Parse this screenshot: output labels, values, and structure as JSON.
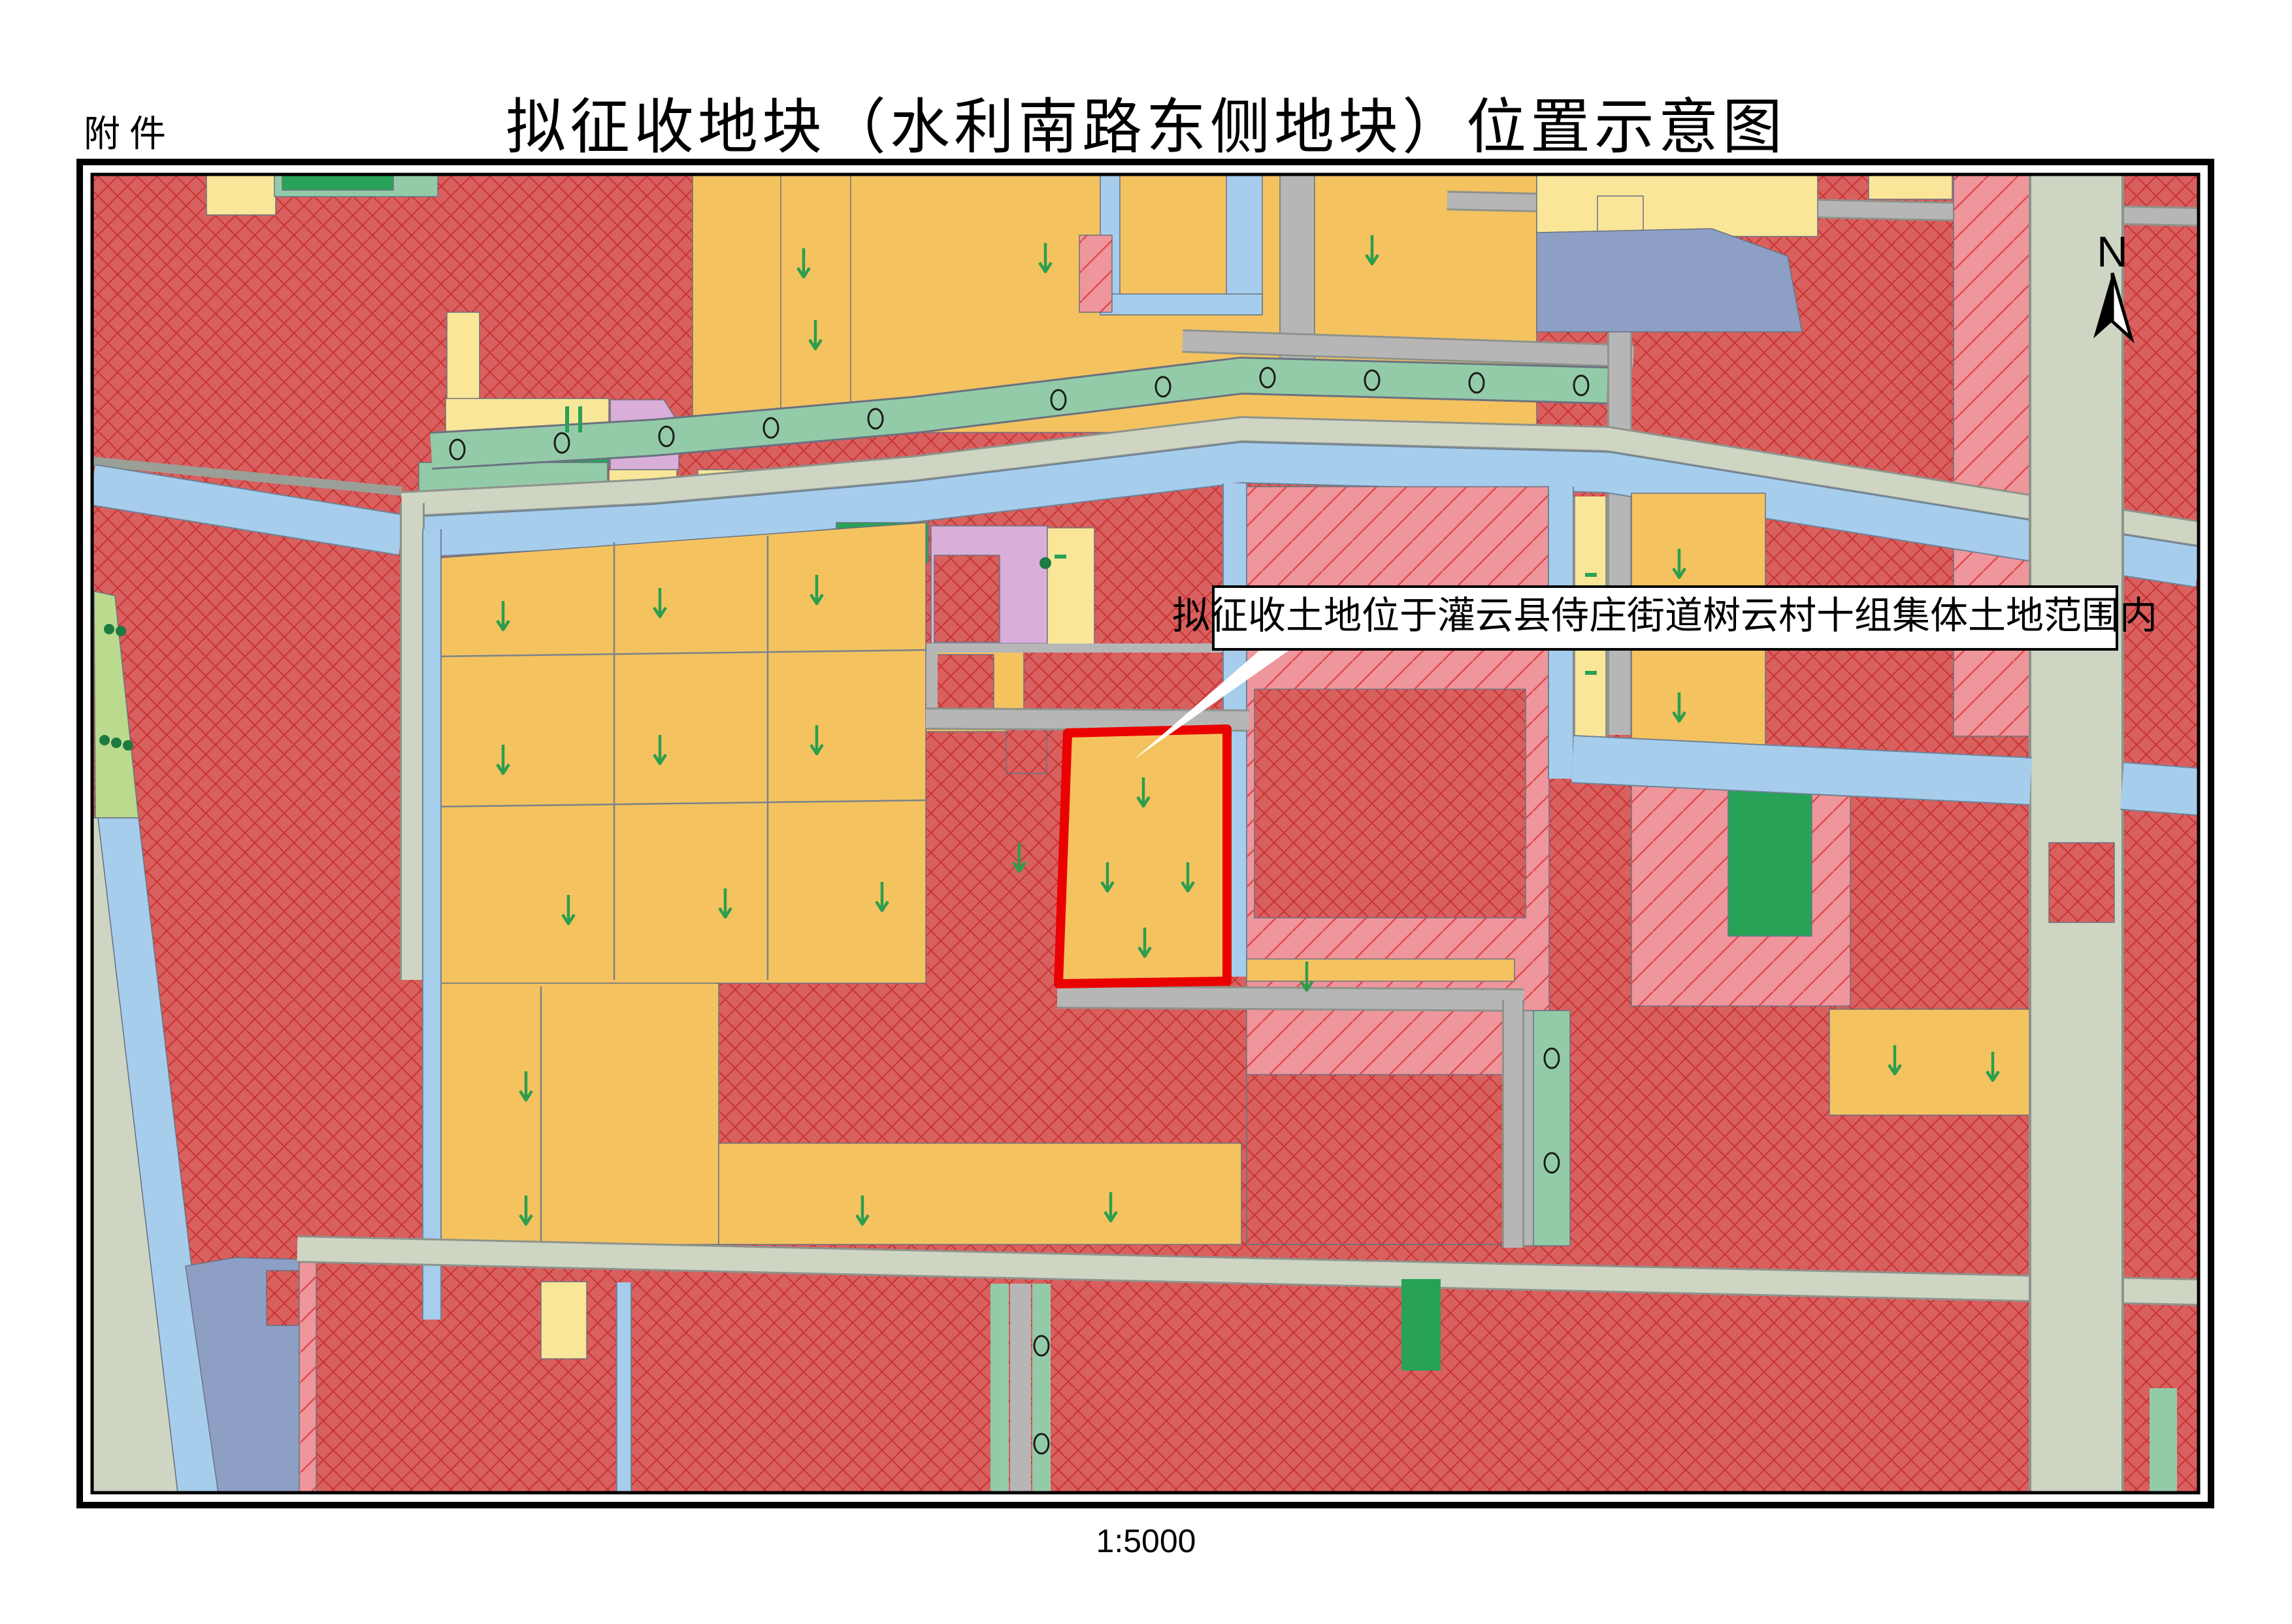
{
  "header": {
    "attachment_label": "附件",
    "title": "拟征收地块（水利南路东侧地块）位置示意图"
  },
  "map": {
    "annotation": "拟征收土地位于灌云县侍庄街道树云村十组集体土地范围内",
    "north_label": "N",
    "target_plot": {
      "outline_color": "#ea0000",
      "description_visible_only_as": "red outlined parcel on farmland"
    },
    "colors": {
      "construction_red_fill": "#d8605f",
      "construction_red_hatch": "#c93333",
      "pink_zone_fill": "#ef959c",
      "pink_zone_hatch": "#e14b4b",
      "farmland_orange": "#f4c360",
      "pale_yellow": "#f9e698",
      "canal_blue": "#a6cdec",
      "pond_slate_blue": "#8d9fc5",
      "road_beige": "#cfd5c3",
      "road_gray": "#b6b6b6",
      "strip_sea_green": "#93cba8",
      "strip_dark_green": "#27a257",
      "strip_light_green": "#bada8e",
      "parcel_lavender": "#d9aed8",
      "arrow_green": "#2d9e4e",
      "frame_black": "#000000"
    }
  },
  "footer": {
    "scale_label": "1:5000"
  }
}
